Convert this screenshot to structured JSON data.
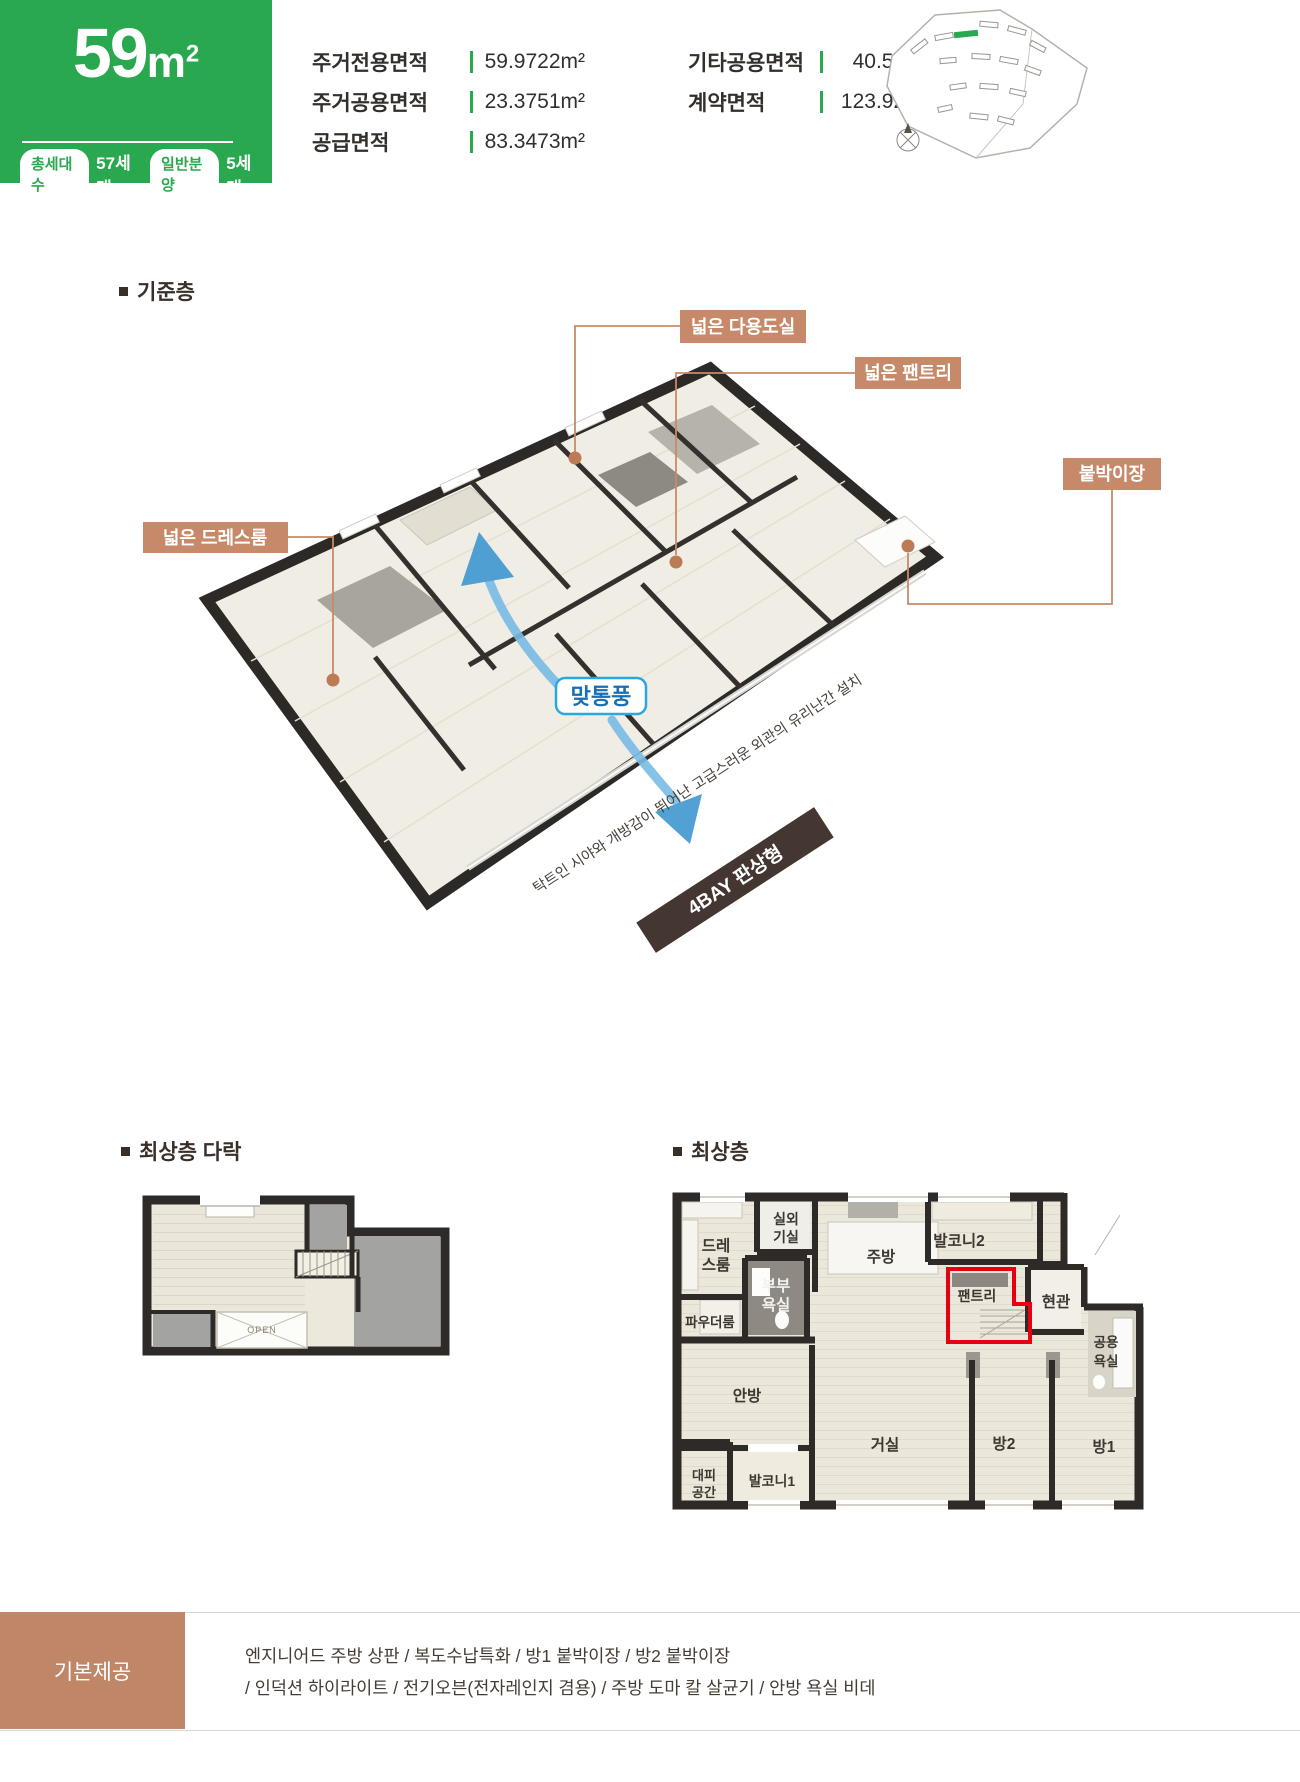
{
  "header": {
    "size_number": "59",
    "size_unit": "m",
    "size_sup": "2",
    "badges": [
      {
        "pill": "총세대수",
        "value": "57세대"
      },
      {
        "pill": "일반분양",
        "value": "5세대"
      }
    ],
    "areas_left": [
      {
        "label": "주거전용면적",
        "value": "59.9722m²"
      },
      {
        "label": "주거공용면적",
        "value": "23.3751m²"
      },
      {
        "label": "공급면적",
        "value": "83.3473m²"
      }
    ],
    "areas_right": [
      {
        "label": "기타공용면적",
        "value": "40.5767m²"
      },
      {
        "label": "계약면적",
        "value": "123.9240m²"
      }
    ]
  },
  "standard_floor": {
    "title": "기준층",
    "callout_utility": "넓은 다용도실",
    "callout_pantry": "넓은 팬트리",
    "callout_closet": "붙박이장",
    "callout_dress": "넓은 드레스룸",
    "cross_vent_label": "맞통풍",
    "ribbon": "4BAY 판상형",
    "note": "탁트인 시야와 개방감이 뛰어난 고급스러운 외관의 유리난간 설치"
  },
  "attic": {
    "title": "최상층 다락",
    "open_label": "OPEN"
  },
  "top_floor": {
    "title": "최상층",
    "rooms": {
      "dress_1": "드레",
      "dress_2": "스룸",
      "outdoor_1": "실외",
      "outdoor_2": "기실",
      "kitchen": "주방",
      "balcony2": "발코니2",
      "couple_bath_1": "부부",
      "couple_bath_2": "욕실",
      "powder": "파우더룸",
      "pantry": "팬트리",
      "entrance": "현관",
      "public_bath_1": "공용",
      "public_bath_2": "욕실",
      "master": "안방",
      "living": "거실",
      "room2": "방2",
      "room1": "방1",
      "shelter_1": "대피",
      "shelter_2": "공간",
      "balcony1": "발코니1"
    }
  },
  "footer": {
    "title": "기본제공",
    "line1": "엔지니어드 주방 상판 / 복도수납특화 / 방1 붙박이장 / 방2 붙박이장",
    "line2": "/ 인덕션 하이라이트 / 전기오븐(전자레인지 겸용) / 주방 도마 칼 살균기 / 안방 욕실 비데"
  },
  "colors": {
    "accent_green": "#2aa84f",
    "callout_tan": "#c68a6a",
    "ribbon_brown": "#443631",
    "vent_border_blue": "#2ba7df",
    "vent_text_blue": "#176fb5",
    "highlight_red": "#e60012",
    "footer_brown": "#bf8768",
    "wall_dark": "#2e2a27"
  }
}
